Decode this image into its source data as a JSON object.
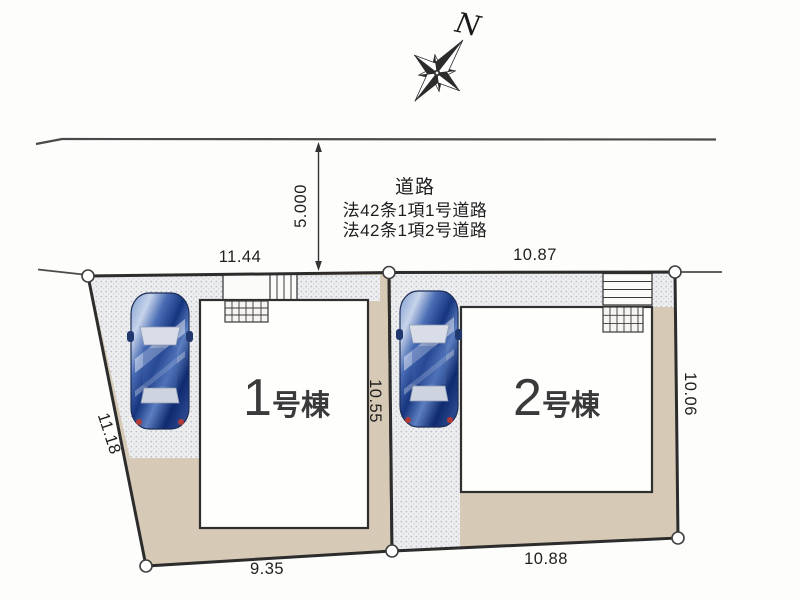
{
  "compass": {
    "north_label": "N"
  },
  "road": {
    "label": "道路",
    "law_line1": "法42条1項1号道路",
    "law_line2": "法42条1項2号道路",
    "width_label": "5.000"
  },
  "lots": [
    {
      "building_no": "1",
      "building_suffix": "号棟",
      "dim_top": "11.44",
      "dim_left": "11.18",
      "dim_right": "10.55",
      "dim_bottom": "9.35"
    },
    {
      "building_no": "2",
      "building_suffix": "号棟",
      "dim_top": "10.87",
      "dim_right": "10.06",
      "dim_bottom": "10.88"
    }
  ],
  "colors": {
    "ground_beige": "#d6c9b5",
    "paving_gray": "#edeef0",
    "outline": "#2c2c2c",
    "car_blue": "#16357f"
  }
}
